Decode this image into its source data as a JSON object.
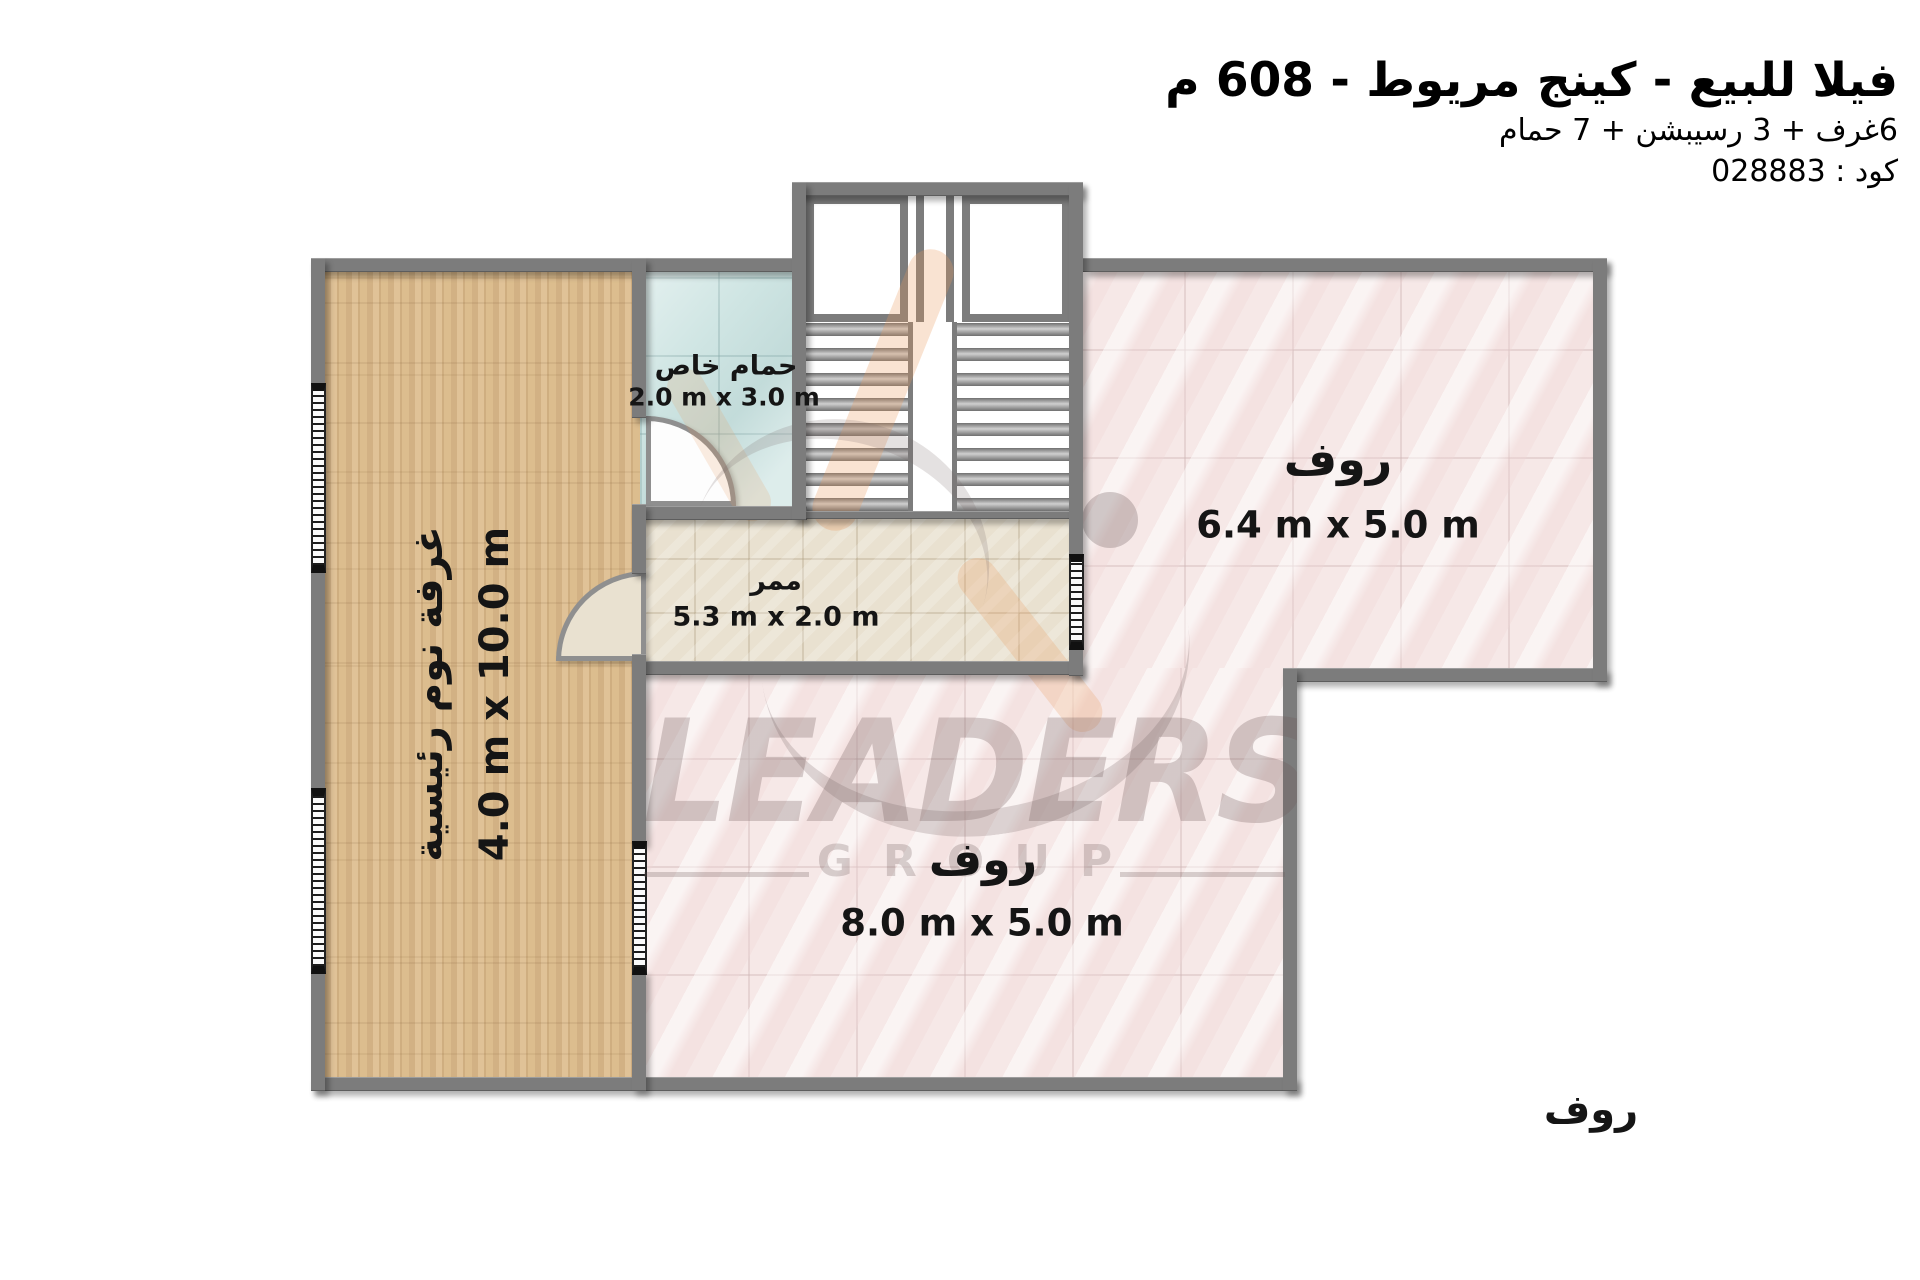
{
  "header": {
    "title": "فيلا للبيع - كينج مريوط - 608 م",
    "subtitle": "6غرف + 3 رسيبشن + 7 حمام",
    "code": "كود : 028883"
  },
  "rooms": {
    "bedroom": {
      "name": "غرفة نوم رئيسية",
      "dims": "4.0 m x 10.0 m"
    },
    "bathroom": {
      "name": "حمام خاص",
      "dims": "2.0 m x 3.0 m"
    },
    "corridor": {
      "name": "ممر",
      "dims": "5.3 m x 2.0 m"
    },
    "roof_right": {
      "name": "روف",
      "dims": "6.4 m x 5.0 m"
    },
    "roof_bottom": {
      "name": "روف",
      "dims": "8.0 m x 5.0 m"
    },
    "roof_outside": {
      "name": "روف"
    }
  },
  "watermark": {
    "brand": "LEADERS",
    "group": "GROUP"
  },
  "colors": {
    "wall": "#7c7c7c",
    "wood_floor": "#d7b68a",
    "bathroom_tile": "#cfe5e3",
    "corridor_tile": "#e9e1d0",
    "roof_tile": "#f6e8e7",
    "logo_orange": "#e99b5c",
    "text": "#000000"
  }
}
